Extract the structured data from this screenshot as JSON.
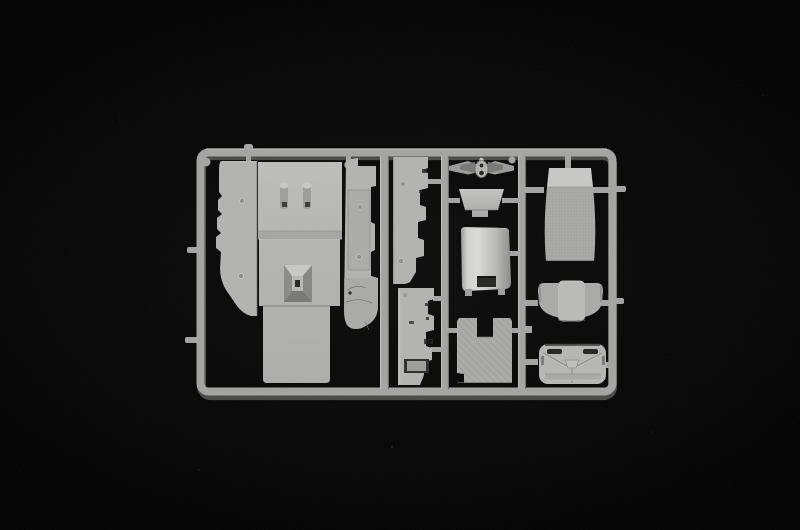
{
  "scene": {
    "type": "product-photo",
    "subject": "plastic-model-kit-sprue",
    "background": "#030303",
    "text_visible": "none"
  },
  "colors": {
    "background": "#030303",
    "rail": "#a3a3a1",
    "rail_shadow": "#565654",
    "rail_highlight": "#cdcdcb",
    "part_face": "#b2b2b0",
    "part_face_light": "#c7c7c5",
    "part_face_dark": "#8e8e8c",
    "part_shadow": "#6e6e6c",
    "recess_dark": "#242422",
    "texture_tone": "#a7a7a5"
  },
  "sprue": {
    "material": "light-grey-styrene",
    "frame": {
      "left": 200,
      "top": 152,
      "right": 613,
      "bottom": 392,
      "rail_width": 8,
      "vertical_runners": 3
    },
    "parts": [
      {
        "name": "cab-floor-panel"
      },
      {
        "name": "door-side-panel"
      },
      {
        "name": "cab-side-panel"
      },
      {
        "name": "engine-tunnel-hatch"
      },
      {
        "name": "mounting-pegs"
      },
      {
        "name": "side-sill-panel-upper"
      },
      {
        "name": "side-sill-panel-lower"
      },
      {
        "name": "steering-bracket"
      },
      {
        "name": "dashboard-cowl"
      },
      {
        "name": "engine-cover"
      },
      {
        "name": "textured-floor-mat"
      },
      {
        "name": "bunk-mattress"
      },
      {
        "name": "seat-backrest"
      },
      {
        "name": "cab-rear-panel"
      }
    ],
    "parts_count": 14
  }
}
